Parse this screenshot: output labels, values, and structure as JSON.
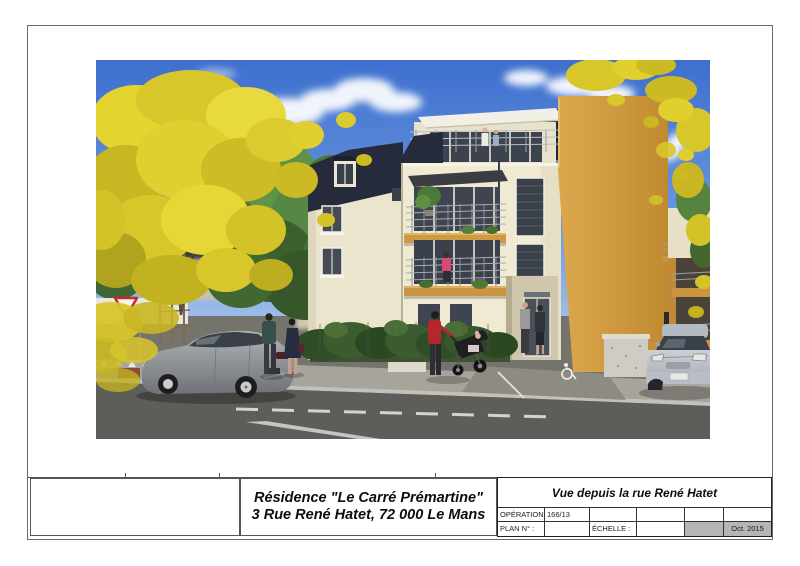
{
  "sheet": {
    "background": "#ffffff",
    "frame_color": "#6a6a6a"
  },
  "rendering": {
    "kind": "architectural-3d-rendering",
    "subject": "three-storey residence with mansard roof, balconies, orange gable wall, street scene with parked cars and pedestrians",
    "palette": {
      "sky_top": "#3d6fce",
      "sky_bottom": "#b8d2ee",
      "facade_cream": "#efe9d2",
      "roof_dark": "#232937",
      "gable_orange": "#d09a3f",
      "balcony_band": "#cd9a41",
      "foliage_yellow": "#e0cf2e",
      "foliage_green": "#55843f",
      "road": "#5d5d5a",
      "sidewalk": "#a7a49b"
    }
  },
  "title_box": {
    "line1": "Résidence \"Le Carré Prémartine\"",
    "line2": "3 Rue René Hatet, 72 000 Le Mans"
  },
  "title_block": {
    "view_title": "Vue  depuis la rue René Hatet",
    "operation_label": "OPÉRATION :",
    "operation_value": "166/13",
    "plan_label": "PLAN N° :",
    "scale_label": "ÉCHELLE :",
    "date_value": "Oct. 2015",
    "grey_cell_color": "#b5b5b5"
  }
}
